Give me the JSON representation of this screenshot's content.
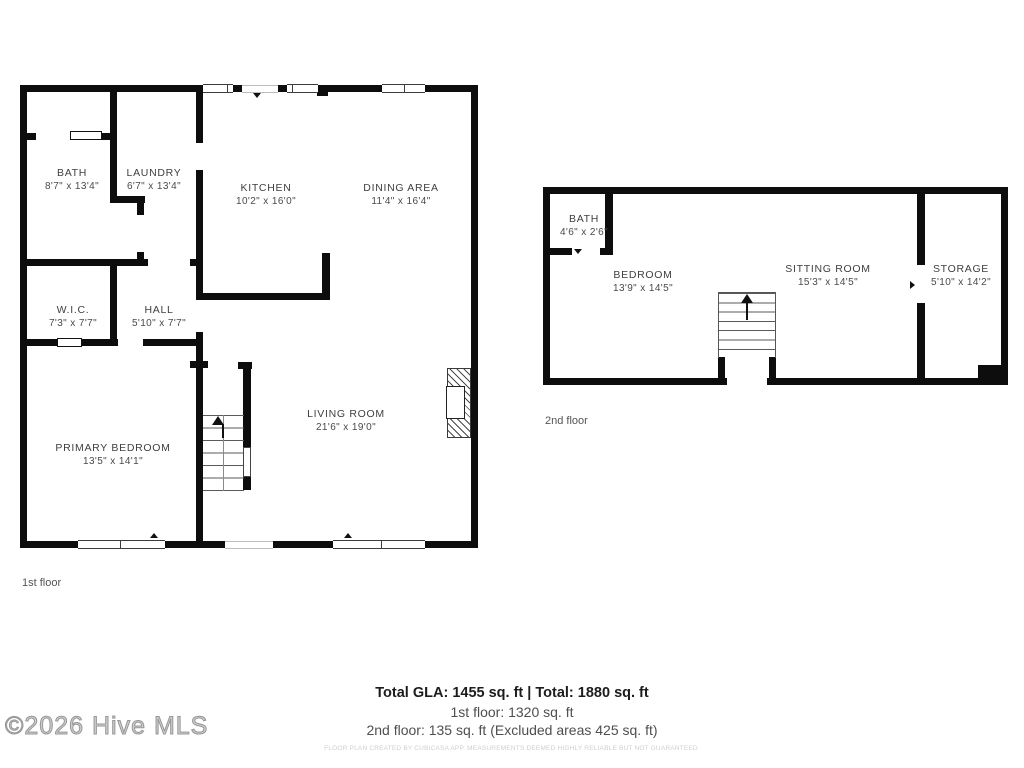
{
  "floors": {
    "first": {
      "label": "1st floor",
      "rooms": {
        "bath": {
          "name": "BATH",
          "dims": "8'7\" x 13'4\""
        },
        "laundry": {
          "name": "LAUNDRY",
          "dims": "6'7\" x 13'4\""
        },
        "kitchen": {
          "name": "KITCHEN",
          "dims": "10'2\" x 16'0\""
        },
        "dining": {
          "name": "DINING AREA",
          "dims": "11'4\" x 16'4\""
        },
        "wic": {
          "name": "W.I.C.",
          "dims": "7'3\" x 7'7\""
        },
        "hall": {
          "name": "HALL",
          "dims": "5'10\" x 7'7\""
        },
        "primary": {
          "name": "PRIMARY BEDROOM",
          "dims": "13'5\" x 14'1\""
        },
        "living": {
          "name": "LIVING ROOM",
          "dims": "21'6\" x 19'0\""
        }
      }
    },
    "second": {
      "label": "2nd floor",
      "rooms": {
        "bath": {
          "name": "BATH",
          "dims": "4'6\" x 2'6\""
        },
        "bedroom": {
          "name": "BEDROOM",
          "dims": "13'9\" x 14'5\""
        },
        "sitting": {
          "name": "SITTING ROOM",
          "dims": "15'3\" x 14'5\""
        },
        "storage": {
          "name": "STORAGE",
          "dims": "5'10\" x 14'2\""
        }
      }
    }
  },
  "summary": {
    "total_line": "Total GLA: 1455 sq. ft | Total: 1880 sq. ft",
    "first_line": "1st floor: 1320 sq. ft",
    "second_line": "2nd floor: 135 sq. ft (Excluded areas 425 sq. ft)",
    "disclaimer": "FLOOR PLAN CREATED BY CUBICASA APP. MEASUREMENTS DEEMED HIGHLY RELIABLE BUT NOT GUARANTEED."
  },
  "watermark": "©2026 Hive MLS",
  "icons": {
    "stairs_up_arrow": "triangle-up",
    "door_swing_marker": "small-triangle"
  },
  "colors": {
    "wall": "#0d0d0d",
    "label_text": "#404040",
    "summary_text": "#1c1c1c",
    "muted_text": "#4f4f4f",
    "disclaimer_text": "#cfcfcf"
  }
}
